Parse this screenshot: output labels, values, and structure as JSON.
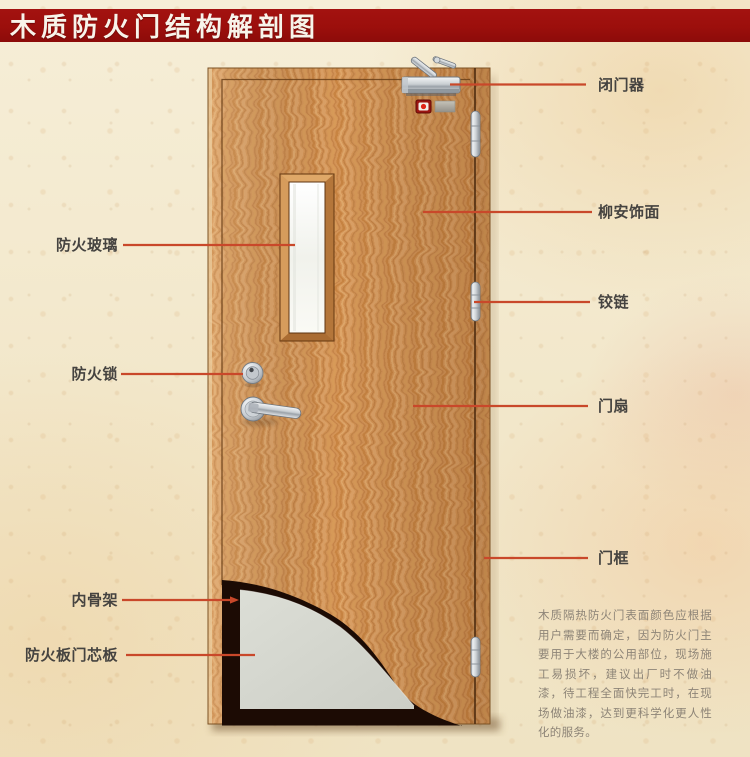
{
  "title": "木质防火门结构解剖图",
  "callouts": {
    "left": [
      {
        "id": "fire-glass",
        "label": "防火玻璃"
      },
      {
        "id": "fire-lock",
        "label": "防火锁"
      },
      {
        "id": "inner-skeleton",
        "label": "内骨架"
      },
      {
        "id": "fire-board-core",
        "label": "防火板门芯板"
      }
    ],
    "right": [
      {
        "id": "door-closer",
        "label": "闭门器"
      },
      {
        "id": "lauan-veneer",
        "label": "柳安饰面"
      },
      {
        "id": "hinge",
        "label": "铰链"
      },
      {
        "id": "door-leaf",
        "label": "门扇"
      },
      {
        "id": "door-frame",
        "label": "门框"
      }
    ]
  },
  "note": "木质隔热防火门表面颜色应根据用户需要而确定，因为防火门主要用于大楼的公用部位，现场施工易损坏，建议出厂时不做油漆，待工程全面快完工时，在现场做油漆，达到更科学化更人性化的服务。",
  "colors": {
    "banner_red": "#9c0f0c",
    "background_parchment": "#f3e9ce",
    "leader_line": "#c9482a",
    "door_wood": "#d49457",
    "core_board_gray": "#d8dad2",
    "skeleton_dark": "#1c0b04",
    "glass_white": "#f7f8f3",
    "metal_silver": "#ccd1d5"
  }
}
